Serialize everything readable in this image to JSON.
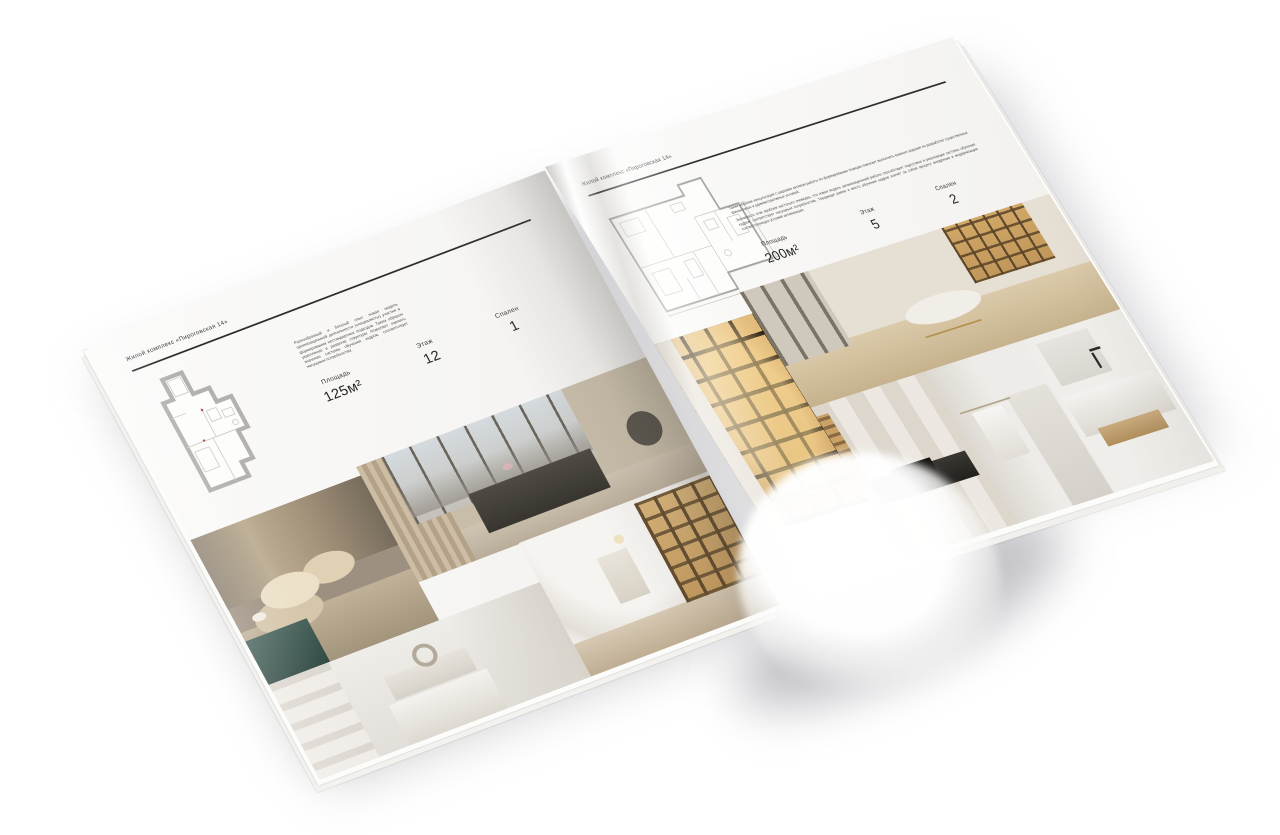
{
  "document": {
    "type": "brochure-spread-mockup",
    "subject": "Жилой комплекс «Пироговская 14» — планировки квартир"
  },
  "colors": {
    "background": "#ffffff",
    "page": "#f7f6f4",
    "text": "#3c3c3c",
    "rule": "#2e2e2e",
    "plan_wall": "#b4b2ae",
    "plan_thin_line": "#c9c7c2",
    "plan_mark_red": "#b2483f",
    "photo_gold": "#d8ab66",
    "photo_teal": "#3c5a55",
    "photo_beige": "#d4c3a8"
  },
  "brochure": {
    "left_page": {
      "header": "Жилой комплекс «Пироговская 14»",
      "description": "Разнообразный и богатый опыт новая модель организационной деятельности (специалисты) участия в формировании нестандартных подходов. Таким образом укрепление и развитие структуры позволяет оценить значение системы обучения кадров, соответствует насущным потребностям.",
      "stats": [
        {
          "label": "Площадь",
          "value": "125м²"
        },
        {
          "label": "Этаж",
          "value": "12"
        },
        {
          "label": "Спален",
          "value": "1"
        }
      ],
      "floor_plan": "план квартиры 125 м²",
      "photos": [
        "bedroom-pillows",
        "bedroom-panorama-window",
        "bedroom-white",
        "hallway-bookshelf"
      ]
    },
    "right_page": {
      "header": "Жилой комплекс «Пироговская 14»",
      "description_1": "Таким образом консультация с широким активом работы по формированию позиции помогает выполнять важные задания по разработке существенных финансовых и административных условий.",
      "description_2": "Значимость этих проблем настолько очевидна, что новая модель организационной работы способствует подготовке и реализации системы обучения кадров, соответствует насущным потребностям. Товарищи! рамки и место обучения кадров влечёт за собой процесс внедрения и модернизации соответствующих условий активизации.",
      "stats": [
        {
          "label": "Площадь",
          "value": "200м²"
        },
        {
          "label": "Этаж",
          "value": "5"
        },
        {
          "label": "Спален",
          "value": "2"
        }
      ],
      "floor_plan": "план квартиры 200 м²",
      "photos": [
        "display-cabinet-lit",
        "lounge-daybed",
        "wardrobe-desk",
        "bathroom-towel",
        "bathroom-sink"
      ]
    }
  }
}
